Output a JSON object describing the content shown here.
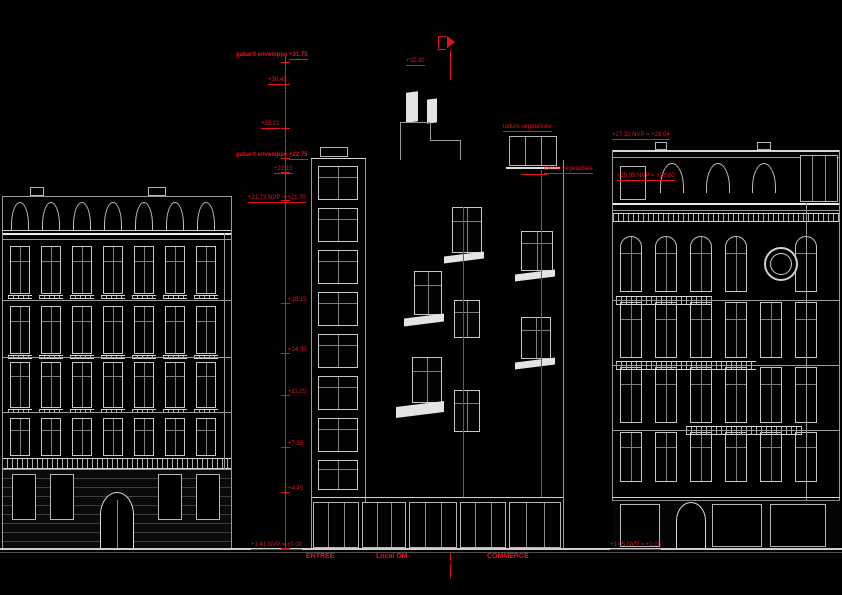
{
  "sheet": {
    "left_annotations": [
      {
        "label": "gabarit enveloppe",
        "value": "+31.75"
      },
      {
        "label": "",
        "value": "+30.48"
      },
      {
        "label": "",
        "value": "+25.21"
      },
      {
        "label": "gabarit enveloppe",
        "value": "+22.75"
      },
      {
        "label": "",
        "value": "+22.10"
      },
      {
        "label": "",
        "value": "+21.73 NVP = +21.70"
      }
    ],
    "floor_levels": [
      "+18.15",
      "+14.35",
      "+11.25",
      "+7.35",
      "+4.45"
    ],
    "street_level_left": "+1.41 NVP = +0.00",
    "street_level_right": "+1.05 NVP = +1.05",
    "ridge_level": "+32.30",
    "roof_labels": [
      "toiture végétalisée",
      "toiture végétalisée"
    ],
    "right_annotations": [
      "+27.32 NVP = +28.04",
      "+25.95 NVP = +26.60"
    ],
    "ground_labels": {
      "entree": "ENTREE",
      "local": "Local OM",
      "commerce": "COMMERCE"
    }
  }
}
